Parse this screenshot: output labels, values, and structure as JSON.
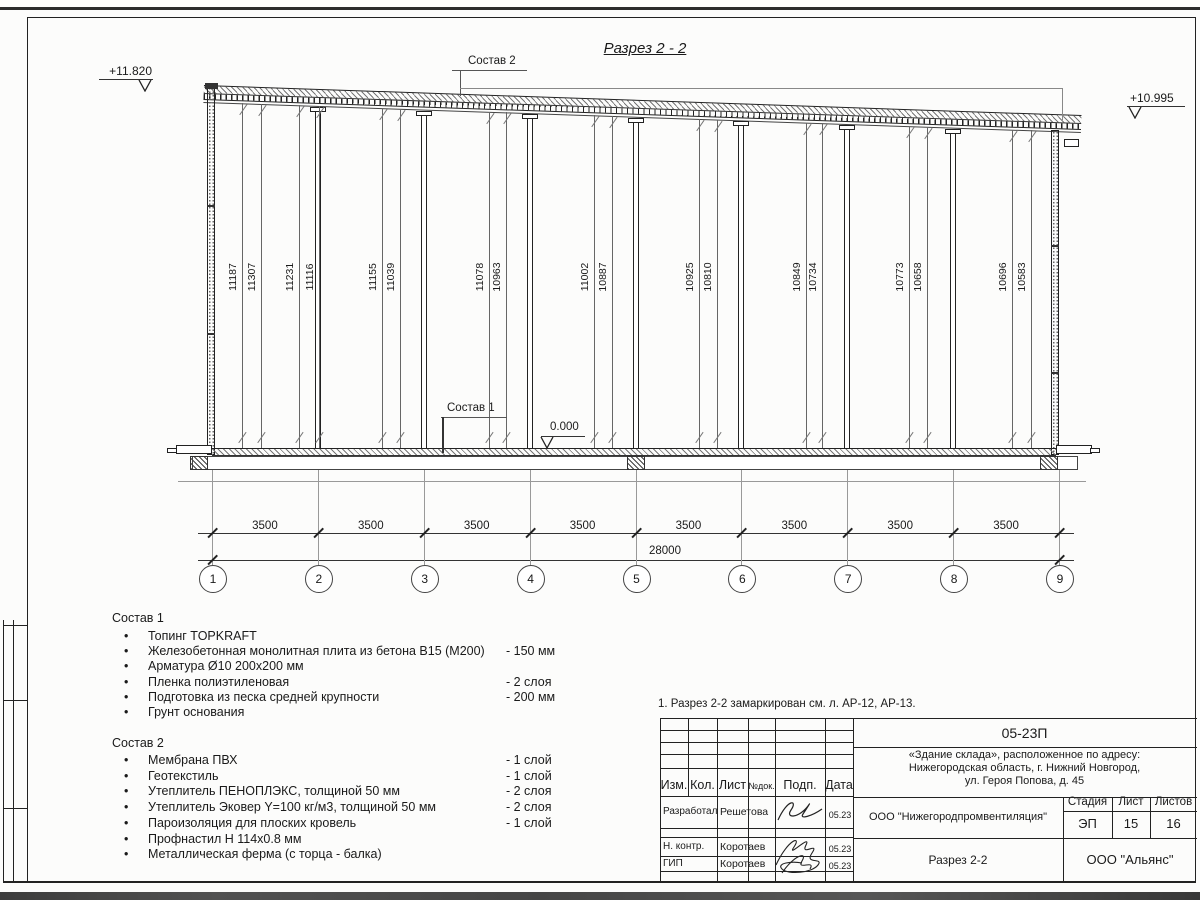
{
  "sheet": {
    "title": "Разрез 2 - 2",
    "note": "1. Разрез 2-2 замаркирован см. л. АР-12, АР-13."
  },
  "drawing": {
    "elevation_top_left": "+11.820",
    "elevation_top_right": "+10.995",
    "elevation_zero": "0.000",
    "composition1_label": "Состав 1",
    "composition2_label": "Состав 2",
    "member_heights": [
      {
        "x": 233,
        "value": "11187"
      },
      {
        "x": 252,
        "value": "11307"
      },
      {
        "x": 290,
        "value": "11231"
      },
      {
        "x": 310,
        "value": "11116"
      },
      {
        "x": 373,
        "value": "11155"
      },
      {
        "x": 391,
        "value": "11039"
      },
      {
        "x": 480,
        "value": "11078"
      },
      {
        "x": 497,
        "value": "10963"
      },
      {
        "x": 585,
        "value": "11002"
      },
      {
        "x": 603,
        "value": "10887"
      },
      {
        "x": 690,
        "value": "10925"
      },
      {
        "x": 708,
        "value": "10810"
      },
      {
        "x": 797,
        "value": "10849"
      },
      {
        "x": 813,
        "value": "10734"
      },
      {
        "x": 900,
        "value": "10773"
      },
      {
        "x": 918,
        "value": "10658"
      },
      {
        "x": 1003,
        "value": "10696"
      },
      {
        "x": 1022,
        "value": "10583"
      }
    ],
    "axes": [
      "1",
      "2",
      "3",
      "4",
      "5",
      "6",
      "7",
      "8",
      "9"
    ],
    "bay_dims": [
      "3500",
      "3500",
      "3500",
      "3500",
      "3500",
      "3500",
      "3500",
      "3500"
    ],
    "total_dim": "28000"
  },
  "composition1": {
    "title": "Состав 1",
    "items": [
      {
        "text": "Топинг TOPKRAFT",
        "qty": ""
      },
      {
        "text": "Железобетонная монолитная плита из бетона В15 (М200)",
        "qty": "-  150 мм"
      },
      {
        "text": "Арматура Ø10 200x200 мм",
        "qty": ""
      },
      {
        "text": "Пленка полиэтиленовая",
        "qty": "- 2 слоя"
      },
      {
        "text": "Подготовка из песка средней крупности",
        "qty": "- 200 мм"
      },
      {
        "text": "Грунт основания",
        "qty": ""
      }
    ]
  },
  "composition2": {
    "title": "Состав 2",
    "items": [
      {
        "text": "Мембрана ПВХ",
        "qty": "- 1 слой"
      },
      {
        "text": "Геотекстиль",
        "qty": "- 1 слой"
      },
      {
        "text": "Утеплитель ПЕНОПЛЭКС, толщиной 50 мм",
        "qty": "- 2 слоя"
      },
      {
        "text": "Утеплитель Эковер Y=100 кг/м3, толщиной 50 мм",
        "qty": "- 2 слоя"
      },
      {
        "text": "Пароизоляция для плоских кровель",
        "qty": "- 1 слой"
      },
      {
        "text": "Профнастил Н 114х0.8 мм",
        "qty": ""
      },
      {
        "text": "Металлическая ферма (с торца - балка)",
        "qty": ""
      }
    ]
  },
  "titleblock": {
    "doc_code": "05-23П",
    "object_address": [
      "«Здание склада», расположенное по адресу:",
      "Нижегородская область, г. Нижний Новгород,",
      "ул. Героя Попова, д. 45"
    ],
    "columns": [
      "Изм.",
      "Кол.",
      "Лист",
      "№док.",
      "Подп.",
      "Дата"
    ],
    "signature_rows": [
      {
        "role": "Разработал",
        "name": "Решетова",
        "date": "05.23"
      },
      {
        "role": "Н. контр.",
        "name": "Коротаев",
        "date": "05.23"
      },
      {
        "role": "ГИП",
        "name": "Коротаев",
        "date": "05.23"
      }
    ],
    "designer": "ООО \"Нижегородпромвентиляция\"",
    "stage_label": "Стадия",
    "sheet_label": "Лист",
    "sheets_label": "Листов",
    "stage": "ЭП",
    "sheet_number": "15",
    "sheets_total": "16",
    "drawing_title": "Разрез 2-2",
    "client": "ООО \"Альянс\""
  }
}
